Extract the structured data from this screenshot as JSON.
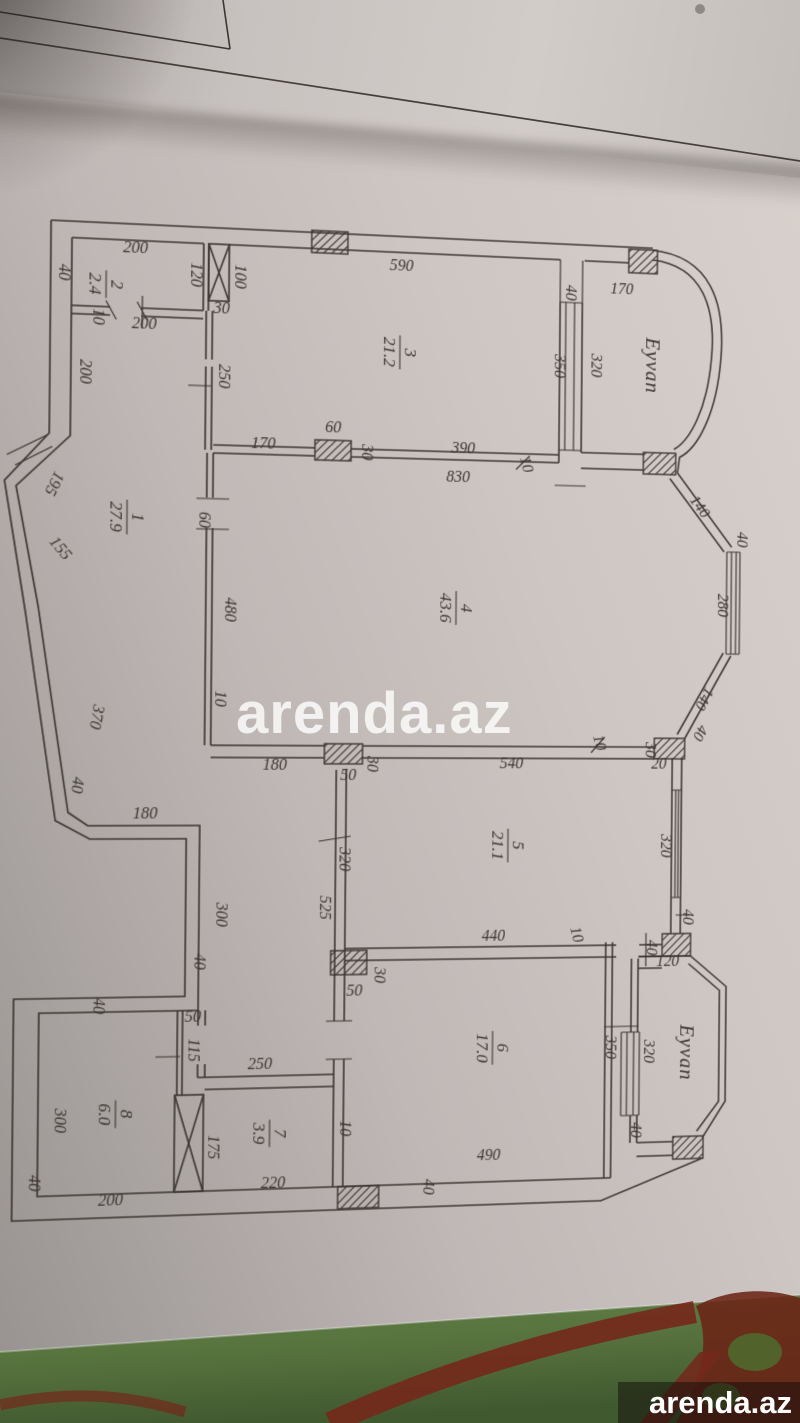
{
  "photo": {
    "watermark_text": "arenda.az",
    "logo_text": "arenda.az"
  },
  "colors": {
    "ink": "#3c3733",
    "cloth_green_light": "#66834a",
    "cloth_green_dark": "#41592f",
    "cloth_red": "#74281b",
    "watermark_white": "#ffffff"
  },
  "plan": {
    "rooms": [
      {
        "number": "1",
        "area": "27.9",
        "x": 130,
        "y": 523
      },
      {
        "number": "2",
        "area": "2.4",
        "x": 108,
        "y": 296
      },
      {
        "number": "3",
        "area": "21.2",
        "x": 397,
        "y": 352
      },
      {
        "number": "4",
        "area": "43.6",
        "x": 456,
        "y": 607
      },
      {
        "number": "5",
        "area": "21.1",
        "x": 511,
        "y": 846
      },
      {
        "number": "6",
        "area": "17.0",
        "x": 497,
        "y": 1050
      },
      {
        "number": "7",
        "area": "3.9",
        "x": 274,
        "y": 1130
      },
      {
        "number": "8",
        "area": "6.0",
        "x": 124,
        "y": 1107
      }
    ],
    "balconies": [
      {
        "label": "Eyvan",
        "x": 650,
        "y": 356
      },
      {
        "label": "Eyvan",
        "x": 692,
        "y": 1059
      }
    ],
    "dim_labels": [
      {
        "t": "200",
        "x": 136,
        "y": 264,
        "r": 0
      },
      {
        "t": "40",
        "x": 63,
        "y": 286,
        "r": 90
      },
      {
        "t": "120",
        "x": 190,
        "y": 283,
        "r": 90
      },
      {
        "t": "100",
        "x": 233,
        "y": 283,
        "r": 90
      },
      {
        "t": "30",
        "x": 220,
        "y": 320,
        "r": 0
      },
      {
        "t": "200",
        "x": 145,
        "y": 338,
        "r": 0
      },
      {
        "t": "10",
        "x": 96,
        "y": 328,
        "r": 90
      },
      {
        "t": "250",
        "x": 218,
        "y": 382,
        "r": 90
      },
      {
        "t": "590",
        "x": 398,
        "y": 270,
        "r": 0
      },
      {
        "t": "40",
        "x": 566,
        "y": 285,
        "r": 90
      },
      {
        "t": "170",
        "x": 624,
        "y": 284,
        "r": 0
      },
      {
        "t": "350",
        "x": 555,
        "y": 360,
        "r": 90
      },
      {
        "t": "320",
        "x": 593,
        "y": 358,
        "r": 90
      },
      {
        "t": "170",
        "x": 262,
        "y": 452,
        "r": 0
      },
      {
        "t": "60",
        "x": 331,
        "y": 434,
        "r": 0
      },
      {
        "t": "30",
        "x": 360,
        "y": 453,
        "r": 90
      },
      {
        "t": "390",
        "x": 462,
        "y": 451,
        "r": 0
      },
      {
        "t": "830",
        "x": 457,
        "y": 480,
        "r": 0
      },
      {
        "t": "10",
        "x": 522,
        "y": 462,
        "r": 75
      },
      {
        "t": "200",
        "x": 84,
        "y": 382,
        "r": 90
      },
      {
        "t": "195",
        "x": 56,
        "y": 490,
        "r": 115
      },
      {
        "t": "155",
        "x": 63,
        "y": 558,
        "r": 50
      },
      {
        "t": "370",
        "x": 98,
        "y": 718,
        "r": 100
      },
      {
        "t": "40",
        "x": 80,
        "y": 785,
        "r": 95
      },
      {
        "t": "180",
        "x": 150,
        "y": 818,
        "r": 0
      },
      {
        "t": "300",
        "x": 220,
        "y": 913,
        "r": 90
      },
      {
        "t": "40",
        "x": 199,
        "y": 959,
        "r": 90
      },
      {
        "t": "40",
        "x": 102,
        "y": 1001,
        "r": 90
      },
      {
        "t": "60",
        "x": 200,
        "y": 524,
        "r": 90
      },
      {
        "t": "480",
        "x": 226,
        "y": 612,
        "r": 90
      },
      {
        "t": "10",
        "x": 217,
        "y": 700,
        "r": 90
      },
      {
        "t": "140",
        "x": 704,
        "y": 502,
        "r": 52
      },
      {
        "t": "40",
        "x": 748,
        "y": 532,
        "r": 90
      },
      {
        "t": "280",
        "x": 728,
        "y": 600,
        "r": 90
      },
      {
        "t": "140",
        "x": 710,
        "y": 694,
        "r": 118
      },
      {
        "t": "40",
        "x": 706,
        "y": 729,
        "r": 118
      },
      {
        "t": "540",
        "x": 514,
        "y": 768,
        "r": 0
      },
      {
        "t": "10",
        "x": 600,
        "y": 743,
        "r": 75
      },
      {
        "t": "30",
        "x": 653,
        "y": 749,
        "r": 90
      },
      {
        "t": "20",
        "x": 667,
        "y": 768,
        "r": 0
      },
      {
        "t": "180",
        "x": 276,
        "y": 770,
        "r": 0
      },
      {
        "t": "30",
        "x": 368,
        "y": 764,
        "r": 90
      },
      {
        "t": "50",
        "x": 349,
        "y": 780,
        "r": 0
      },
      {
        "t": "320",
        "x": 670,
        "y": 847,
        "r": 90
      },
      {
        "t": "40",
        "x": 694,
        "y": 920,
        "r": 90
      },
      {
        "t": "320",
        "x": 341,
        "y": 859,
        "r": 90
      },
      {
        "t": "525",
        "x": 322,
        "y": 907,
        "r": 90
      },
      {
        "t": "440",
        "x": 497,
        "y": 942,
        "r": 0
      },
      {
        "t": "10",
        "x": 578,
        "y": 938,
        "r": 75
      },
      {
        "t": "30",
        "x": 377,
        "y": 975,
        "r": 90
      },
      {
        "t": "50",
        "x": 357,
        "y": 995,
        "r": 0
      },
      {
        "t": "350",
        "x": 614,
        "y": 1052,
        "r": 90
      },
      {
        "t": "490",
        "x": 494,
        "y": 1163,
        "r": 0
      },
      {
        "t": "40",
        "x": 428,
        "y": 1188,
        "r": 90
      },
      {
        "t": "10",
        "x": 344,
        "y": 1127,
        "r": 90
      },
      {
        "t": "40",
        "x": 656,
        "y": 951,
        "r": 90
      },
      {
        "t": "120",
        "x": 678,
        "y": 970,
        "r": 0
      },
      {
        "t": "320",
        "x": 654,
        "y": 1057,
        "r": 90
      },
      {
        "t": "40",
        "x": 641,
        "y": 1137,
        "r": 90
      },
      {
        "t": "50",
        "x": 198,
        "y": 1018,
        "r": 0
      },
      {
        "t": "115",
        "x": 194,
        "y": 1046,
        "r": 90
      },
      {
        "t": "250",
        "x": 264,
        "y": 1066,
        "r": 0
      },
      {
        "t": "300",
        "x": 66,
        "y": 1112,
        "r": 90
      },
      {
        "t": "40",
        "x": 42,
        "y": 1172,
        "r": 90
      },
      {
        "t": "200",
        "x": 120,
        "y": 1196,
        "r": 0
      },
      {
        "t": "175",
        "x": 214,
        "y": 1142,
        "r": 90
      },
      {
        "t": "220",
        "x": 278,
        "y": 1184,
        "r": 0
      }
    ]
  }
}
